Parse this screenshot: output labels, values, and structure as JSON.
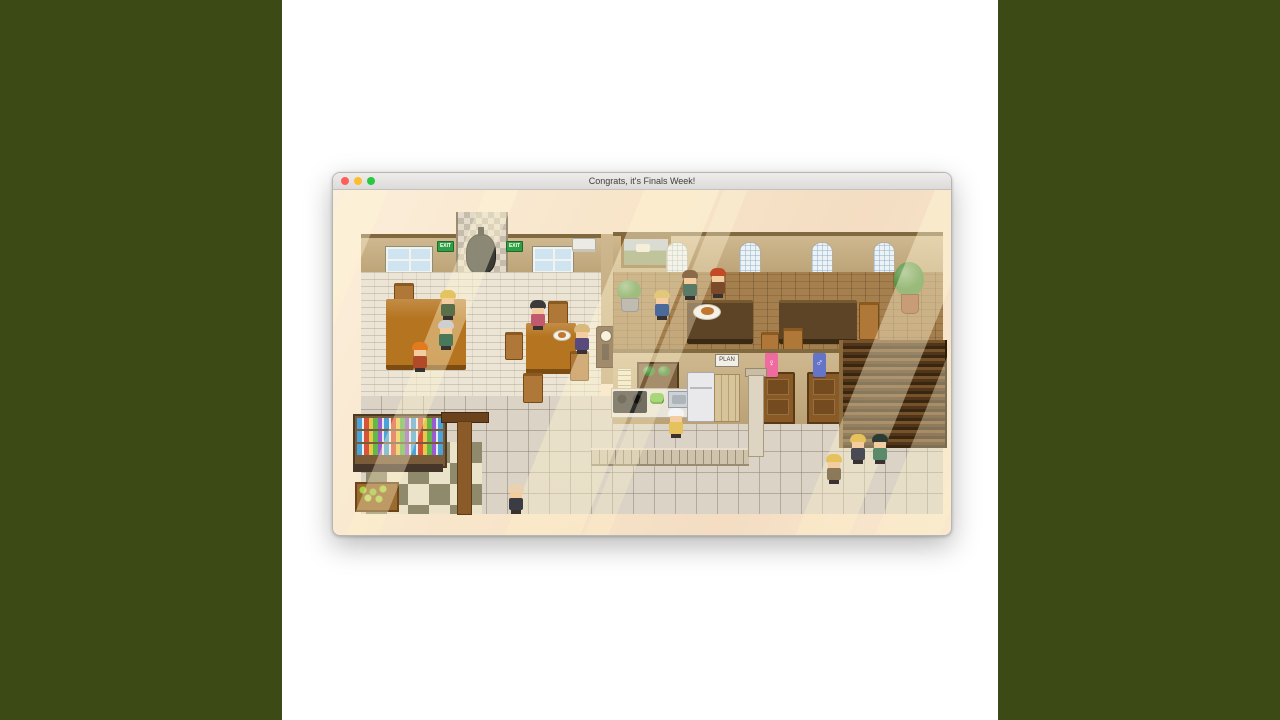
{
  "window": {
    "title": "Congrats, it's Finals Week!",
    "traffic_lights": {
      "close": "#ff5f57",
      "minimize": "#febc2e",
      "zoom": "#28c840"
    }
  },
  "signs": {
    "exit": "EXIT",
    "plan": "PLAN",
    "female": "♀",
    "male": "♂"
  },
  "colors": {
    "side_bar": "#3c4a15",
    "titlebar_text": "#3e3e3a",
    "game_margin": "#f8e6cb",
    "exit_green": "#2f9e44",
    "restroom_pink": "#ef6a9e",
    "restroom_blue": "#6474c8",
    "wall_tan": "#c7ac7d",
    "parquet_wood": "#a5804e",
    "table_wood": "#b5741f",
    "stairs_brown": "#50351a"
  },
  "scene": {
    "characters": [
      {
        "name": "blonde-student-table1",
        "x": 106,
        "y": 100,
        "hair": "#e3c55e",
        "body": "#5a6e4a"
      },
      {
        "name": "elder-green",
        "x": 104,
        "y": 130,
        "hair": "#cfcfcf",
        "body": "#49795a"
      },
      {
        "name": "orange-hair-student",
        "x": 78,
        "y": 152,
        "hair": "#e47a1e",
        "body": "#b04a28"
      },
      {
        "name": "black-hair-girl",
        "x": 196,
        "y": 110,
        "hair": "#3b3b3b",
        "body": "#c25a6e"
      },
      {
        "name": "seated-blonde",
        "x": 240,
        "y": 134,
        "hair": "#d9b97c",
        "body": "#584a7c"
      },
      {
        "name": "blonde-patron",
        "x": 320,
        "y": 100,
        "hair": "#e2c87a",
        "body": "#4a6a9c"
      },
      {
        "name": "green-jacket-server",
        "x": 348,
        "y": 80,
        "hair": "#8a6a48",
        "body": "#5a7a68"
      },
      {
        "name": "mohawk-server",
        "x": 376,
        "y": 78,
        "hair": "#c24a26",
        "body": "#7a4a2a"
      },
      {
        "name": "chef",
        "x": 334,
        "y": 218,
        "hair": "#f4f4f4",
        "body": "#e5c25c"
      },
      {
        "name": "bald-student",
        "x": 174,
        "y": 294,
        "hair": "#ead2b0",
        "body": "#3b3b44"
      },
      {
        "name": "walking-girl",
        "x": 492,
        "y": 264,
        "hair": "#e5c25c",
        "body": "#8a7a5a"
      },
      {
        "name": "walking-blonde-boy",
        "x": 516,
        "y": 244,
        "hair": "#e5c25c",
        "body": "#4a4a54"
      },
      {
        "name": "walking-green-boy",
        "x": 538,
        "y": 244,
        "hair": "#2c3c34",
        "body": "#5a8a6a"
      }
    ]
  }
}
